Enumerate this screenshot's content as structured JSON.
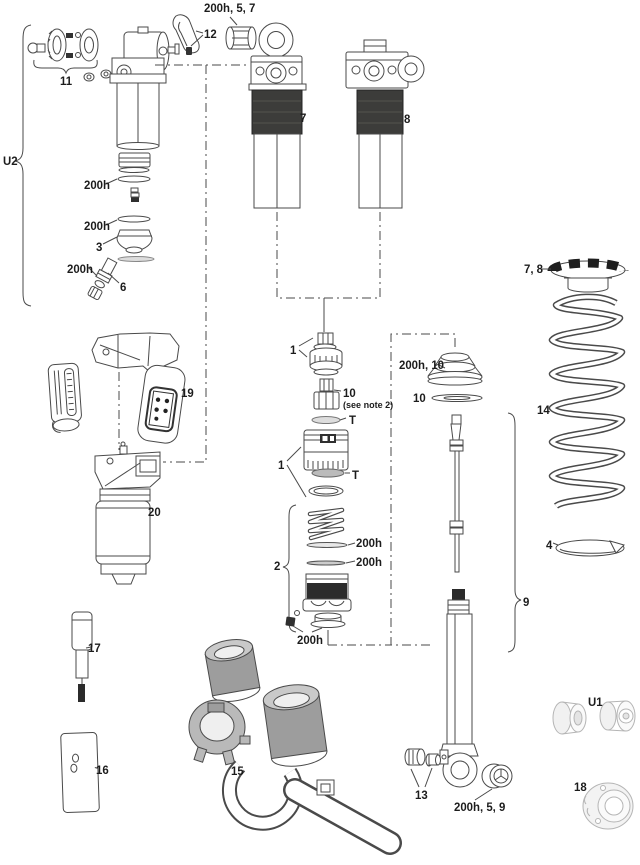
{
  "diagram": {
    "colors": {
      "line": "#4a4a4a",
      "dark_band": "#3c3c3a",
      "gray_part": "#9d9d9d",
      "light_gray_part": "#b5b5b5",
      "background": "#ffffff"
    }
  },
  "labels": {
    "top_bushing": "200h, 5, 7",
    "lever": "12",
    "dial_assembly": "11",
    "u2": "U2",
    "oring_a": "200h",
    "oring_b": "200h",
    "seal_head": "3",
    "valve_oring": "200h",
    "valve": "6",
    "shock7": "7",
    "shock8": "8",
    "spring_retainer": "7, 8",
    "coil_spring": "14",
    "clip": "4",
    "one_a": "1",
    "ten_a": "10",
    "note": "(see note 2)",
    "t_a": "T",
    "one_b": "1",
    "t_b": "T",
    "boot": "200h, 10",
    "ten_b": "10",
    "two": "2",
    "washer_a": "200h",
    "washer_b": "200h",
    "bottom_valve": "200h",
    "nine": "9",
    "module": "19",
    "pump_body": "20",
    "tool": "17",
    "block": "16",
    "kit": "15",
    "hardware": "13",
    "eyelet_bushing": "200h, 5, 9",
    "u1": "U1",
    "spacer": "18"
  }
}
